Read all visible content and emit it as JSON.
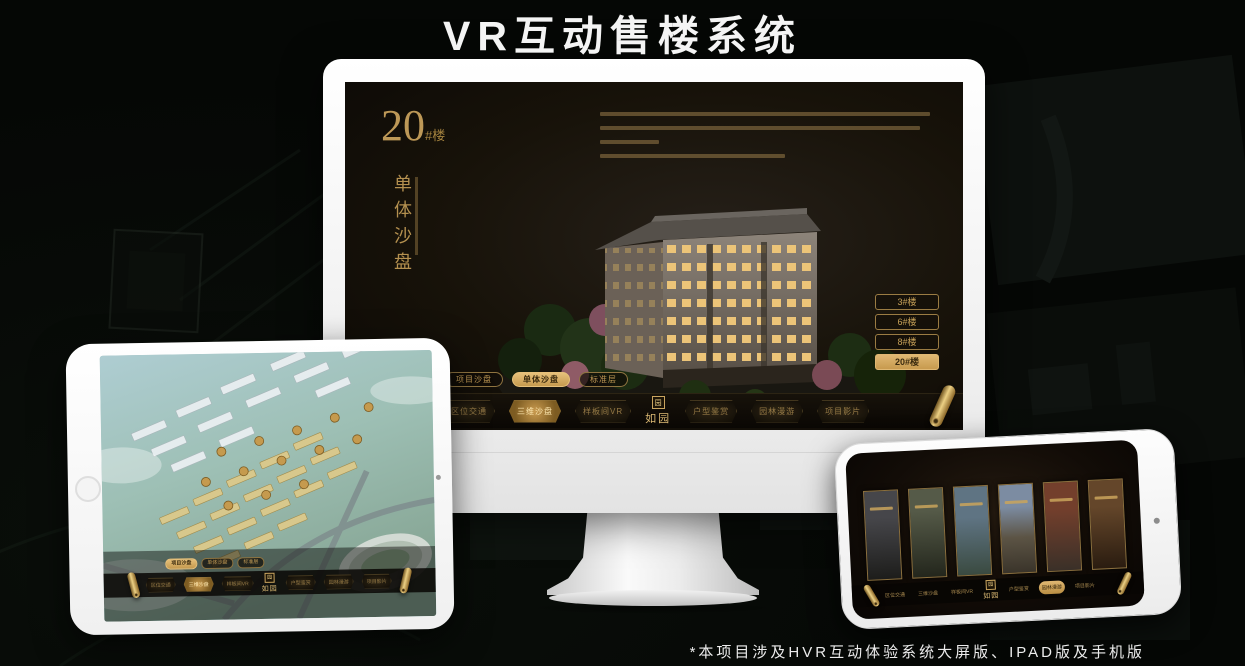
{
  "header": {
    "title": "VR互动售楼系统"
  },
  "footer": {
    "note": "*本项目涉及HVR互动体验系统大屏版、IPAD版及手机版"
  },
  "brand": {
    "logo": "如园",
    "logo_mark": "园"
  },
  "nav": {
    "items": [
      "区位交通",
      "三维沙盘",
      "样板间VR",
      "户型鉴赏",
      "园林漫游",
      "项目影片"
    ]
  },
  "tabs": {
    "items": [
      "项目沙盘",
      "单体沙盘",
      "标准层"
    ]
  },
  "monitor_screen": {
    "block_number": "20",
    "block_unit": "#楼",
    "block_title": "单体沙盘",
    "floor_buttons": [
      "3#楼",
      "6#楼",
      "8#楼",
      "20#楼"
    ],
    "selected_floor": "20#楼",
    "selected_tab": "单体沙盘",
    "selected_nav": "三维沙盘"
  },
  "tablet_screen": {
    "selected_tab": "项目沙盘",
    "selected_nav": "三维沙盘"
  },
  "phone_screen": {
    "selected_nav": "园林漫游"
  },
  "colors": {
    "gold": "#c9a45f",
    "gold_bright": "#e6c07a",
    "screen_bg": "#171209",
    "frame_white": "#f5f5f5"
  }
}
